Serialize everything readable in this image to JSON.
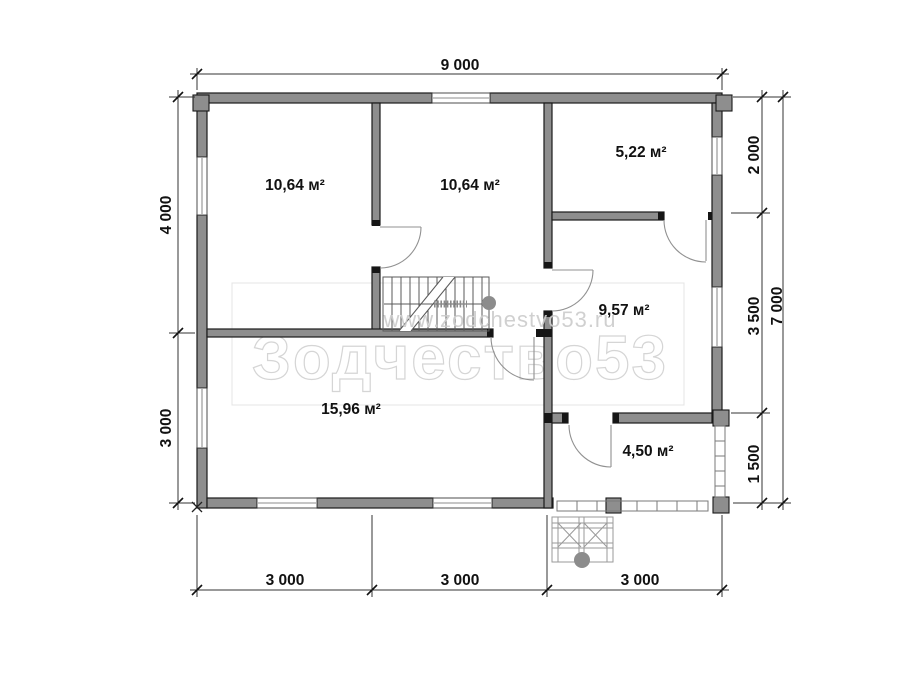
{
  "watermark": {
    "title": "Зодчество53",
    "url": "www.zodchestvo53.ru"
  },
  "rooms": [
    {
      "id": "room-1",
      "area": "10,64 м²"
    },
    {
      "id": "room-2",
      "area": "10,64 м²"
    },
    {
      "id": "room-3",
      "area": "5,22 м²"
    },
    {
      "id": "room-4",
      "area": "9,57 м²"
    },
    {
      "id": "room-5",
      "area": "15,96 м²"
    },
    {
      "id": "room-6",
      "area": "4,50 м²"
    }
  ],
  "dimensions": {
    "top": [
      "9 000"
    ],
    "left": [
      "4 000",
      "3 000"
    ],
    "right_inner": [
      "2 000",
      "3 500",
      "1 500"
    ],
    "right_outer": [
      "7 000"
    ],
    "bottom": [
      "3 000",
      "3 000",
      "3 000"
    ]
  },
  "colors": {
    "wall": "#8e8e8e",
    "text": "#111111",
    "watermark": "#d5d5d5"
  }
}
